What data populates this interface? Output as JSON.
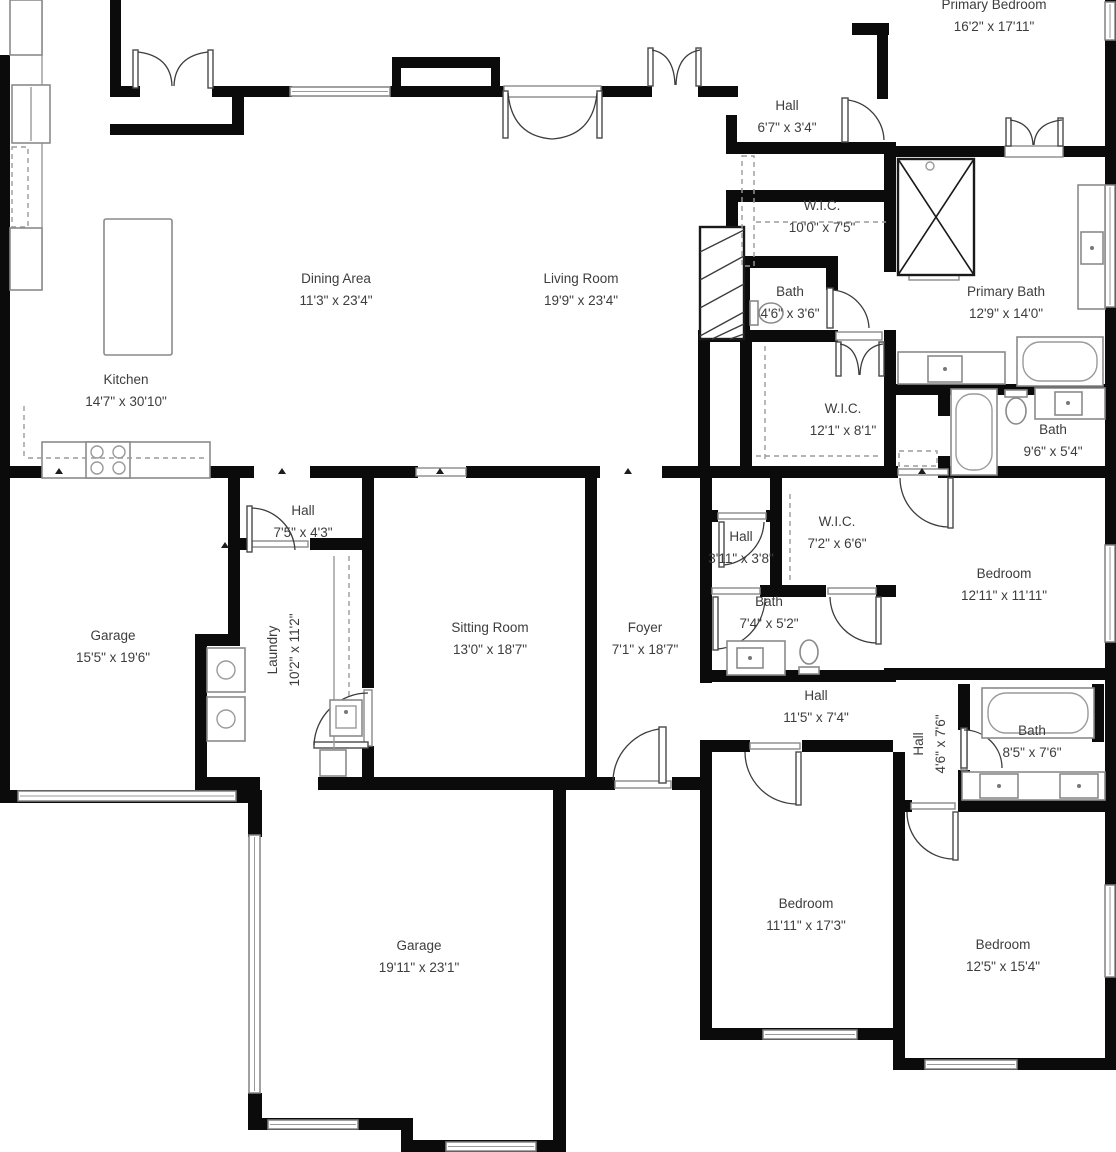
{
  "plan": {
    "type": "residential-floor-plan",
    "colors": {
      "wall": "#0b0b0b",
      "text": "#3d3d3d",
      "fixture": "#8a8a8a",
      "dash": "#9b9b9b",
      "background": "#ffffff"
    },
    "rooms": [
      {
        "name": "Primary Bedroom",
        "dims": "16'2\" x 17'11\"",
        "cx": 994,
        "cy": 16,
        "rot": 0
      },
      {
        "name": "Hall",
        "dims": "6'7\" x 3'4\"",
        "cx": 787,
        "cy": 117,
        "rot": 0
      },
      {
        "name": "W.I.C.",
        "dims": "10'0\" x 7'5\"",
        "cx": 822,
        "cy": 217,
        "rot": 0
      },
      {
        "name": "Dining Area",
        "dims": "11'3\" x 23'4\"",
        "cx": 336,
        "cy": 290,
        "rot": 0
      },
      {
        "name": "Living Room",
        "dims": "19'9\" x 23'4\"",
        "cx": 581,
        "cy": 290,
        "rot": 0
      },
      {
        "name": "Bath",
        "dims": "4'6\" x 3'6\"",
        "cx": 790,
        "cy": 303,
        "rot": 0
      },
      {
        "name": "Primary Bath",
        "dims": "12'9\" x 14'0\"",
        "cx": 1006,
        "cy": 303,
        "rot": 0
      },
      {
        "name": "Kitchen",
        "dims": "14'7\" x 30'10\"",
        "cx": 126,
        "cy": 391,
        "rot": 0
      },
      {
        "name": "W.I.C.",
        "dims": "12'1\" x 8'1\"",
        "cx": 843,
        "cy": 420,
        "rot": 0
      },
      {
        "name": "Bath",
        "dims": "9'6\" x 5'4\"",
        "cx": 1053,
        "cy": 441,
        "rot": 0
      },
      {
        "name": "Hall",
        "dims": "7'5\" x 4'3\"",
        "cx": 303,
        "cy": 522,
        "rot": 0
      },
      {
        "name": "W.I.C.",
        "dims": "7'2\" x 6'6\"",
        "cx": 837,
        "cy": 533,
        "rot": 0
      },
      {
        "name": "Hall",
        "dims": "3'11\" x 3'8\"",
        "cx": 741,
        "cy": 548,
        "rot": 0
      },
      {
        "name": "Bedroom",
        "dims": "12'11\" x 11'11\"",
        "cx": 1004,
        "cy": 585,
        "rot": 0
      },
      {
        "name": "Bath",
        "dims": "7'4\" x 5'2\"",
        "cx": 769,
        "cy": 613,
        "rot": 0
      },
      {
        "name": "Garage",
        "dims": "15'5\" x 19'6\"",
        "cx": 113,
        "cy": 647,
        "rot": 0
      },
      {
        "name": "Sitting Room",
        "dims": "13'0\" x 18'7\"",
        "cx": 490,
        "cy": 639,
        "rot": 0
      },
      {
        "name": "Foyer",
        "dims": "7'1\" x 18'7\"",
        "cx": 645,
        "cy": 639,
        "rot": 0
      },
      {
        "name": "Laundry",
        "dims": "10'2\" x 11'2\"",
        "cx": 284,
        "cy": 650,
        "rot": -90
      },
      {
        "name": "Hall",
        "dims": "11'5\" x 7'4\"",
        "cx": 816,
        "cy": 707,
        "rot": 0
      },
      {
        "name": "Bath",
        "dims": "8'5\" x 7'6\"",
        "cx": 1032,
        "cy": 742,
        "rot": 0
      },
      {
        "name": "Hall",
        "dims": "4'6\" x 7'6\"",
        "cx": 930,
        "cy": 744,
        "rot": -90
      },
      {
        "name": "Bedroom",
        "dims": "11'11\" x 17'3\"",
        "cx": 806,
        "cy": 915,
        "rot": 0
      },
      {
        "name": "Garage",
        "dims": "19'11\" x 23'1\"",
        "cx": 419,
        "cy": 957,
        "rot": 0
      },
      {
        "name": "Bedroom",
        "dims": "12'5\" x 15'4\"",
        "cx": 1003,
        "cy": 956,
        "rot": 0
      }
    ]
  }
}
